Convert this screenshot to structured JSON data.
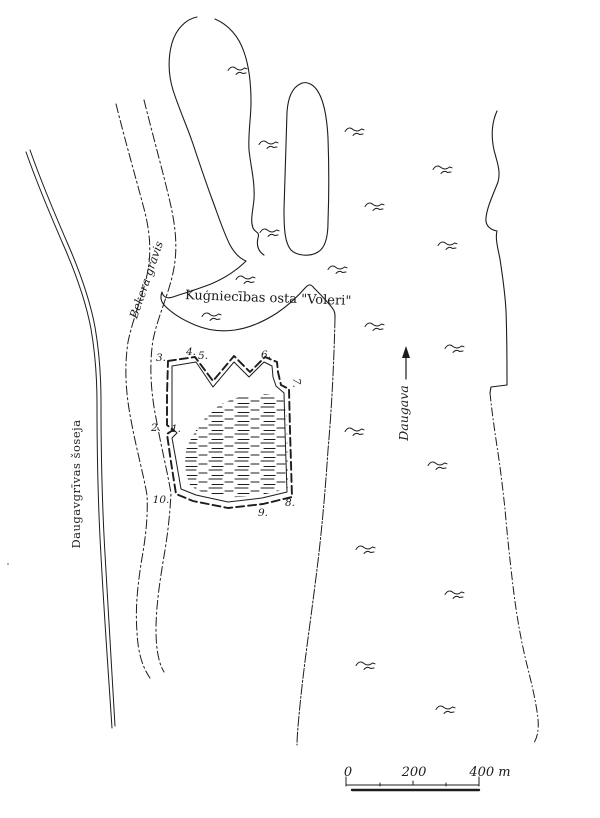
{
  "map": {
    "ink_color": "#1c1c1c",
    "paper_color": "#ffffff",
    "labels": {
      "port": "Kuģniecības osta \"Voleri\"",
      "ditch": "Bekera grāvis",
      "road": "Daugavgrīvas šoseja",
      "river": "Daugava"
    },
    "site_markers": [
      {
        "label": "1."
      },
      {
        "label": "2."
      },
      {
        "label": "3."
      },
      {
        "label": "4."
      },
      {
        "label": "5."
      },
      {
        "label": "6."
      },
      {
        "label": "7."
      },
      {
        "label": "8."
      },
      {
        "label": "9."
      },
      {
        "label": "10."
      }
    ],
    "scale_bar": {
      "labels": [
        "0",
        "200",
        "400 m"
      ]
    }
  }
}
